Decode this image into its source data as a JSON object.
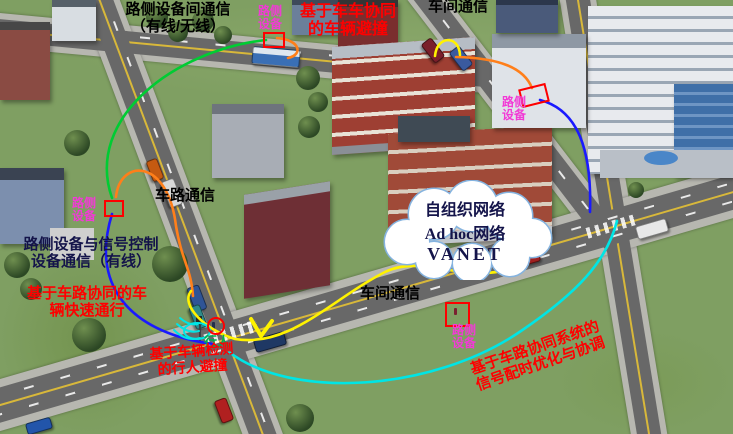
{
  "labels": {
    "roadside_link": {
      "line1": "路侧设备间通信",
      "line2": "（有线/无线）"
    },
    "v2v_avoidance": {
      "line1": "基于车车协同",
      "line2": "的车辆避撞"
    },
    "v2v_top": "车间通信",
    "roadside_device": {
      "line1": "路侧",
      "line2": "设备"
    },
    "v2r": "车路通信",
    "roadside_signal": {
      "line1": "路侧设备与信号控制",
      "line2": "设备通信（有线）"
    },
    "fast_pass": {
      "line1": "基于车路协同的车",
      "line2": "辆快速通行"
    },
    "cloud": {
      "line1": "自组织网络",
      "line2": "Ad hoc网络",
      "line3": "VANET"
    },
    "v2v_center": "车间通信",
    "pedestrian": "行人",
    "ped_avoidance": {
      "line1": "基于车辆检测",
      "line2": "的行人避撞"
    },
    "signal_timing": {
      "line1": "基于车路协同系统的",
      "line2": "信号配时优化与协调"
    }
  },
  "colors": {
    "green": "#00cc33",
    "orange": "#ff7f1a",
    "blue": "#1a1aff",
    "yellow": "#fff200",
    "cyan": "#00e5e5",
    "magenta": "#f23ad6",
    "red": "#fe0000",
    "black": "#000000",
    "navy": "#14144a",
    "cloud_text": "#17365d",
    "cloud_border": "#85b3df",
    "pedestrian_green": "#00b050"
  }
}
